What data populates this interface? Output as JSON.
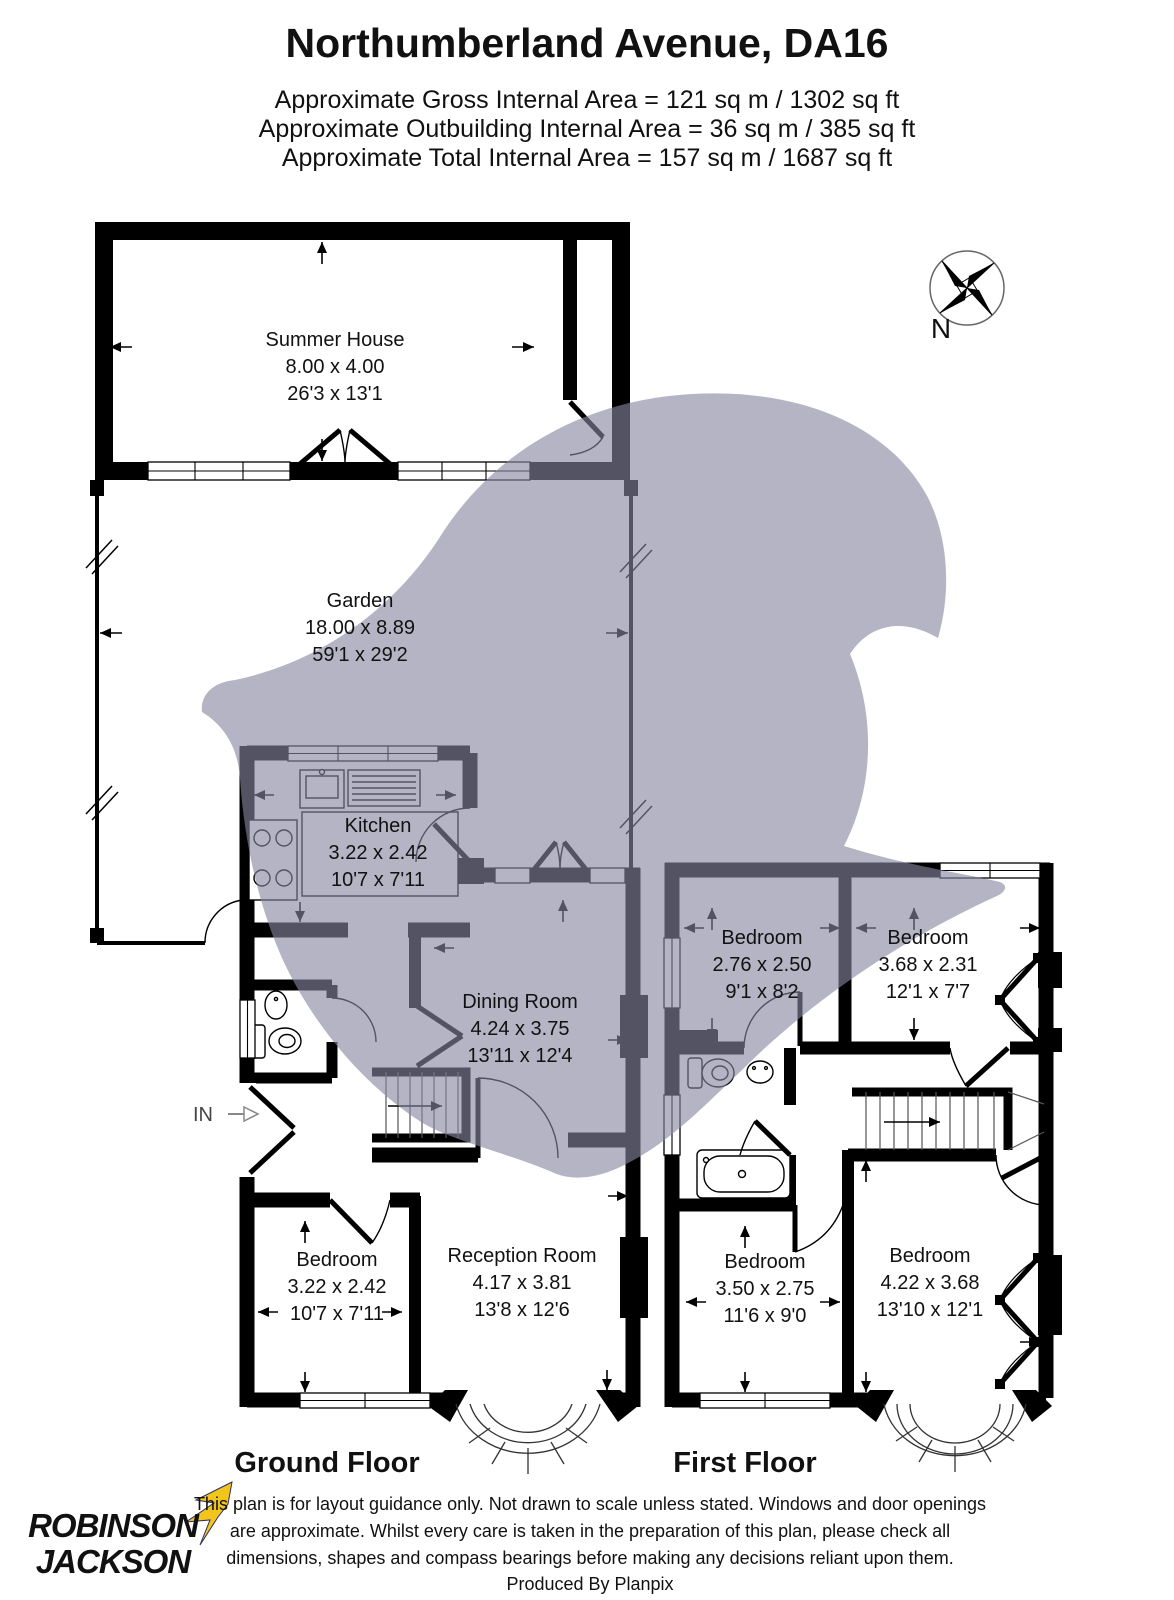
{
  "header": {
    "title": "Northumberland Avenue, DA16",
    "area_lines": [
      "Approximate Gross Internal Area = 121 sq m / 1302 sq ft",
      "Approximate Outbuilding Internal Area = 36 sq m / 385 sq ft",
      "Approximate Total Internal Area = 157 sq m / 1687 sq ft"
    ]
  },
  "compass": {
    "north_label": "N"
  },
  "entrance": {
    "in_label": "IN"
  },
  "rooms": [
    {
      "name": "Summer House",
      "dim_m": "8.00 x 4.00",
      "dim_ft": "26'3 x 13'1"
    },
    {
      "name": "Garden",
      "dim_m": "18.00 x 8.89",
      "dim_ft": "59'1 x 29'2"
    },
    {
      "name": "Kitchen",
      "dim_m": "3.22 x 2.42",
      "dim_ft": "10'7 x 7'11"
    },
    {
      "name": "Dining Room",
      "dim_m": "4.24 x 3.75",
      "dim_ft": "13'11 x 12'4"
    },
    {
      "name": "Bedroom",
      "dim_m": "3.22 x 2.42",
      "dim_ft": "10'7 x 7'11"
    },
    {
      "name": "Reception Room",
      "dim_m": "4.17 x 3.81",
      "dim_ft": "13'8 x 12'6"
    },
    {
      "name": "Bedroom",
      "dim_m": "2.76 x 2.50",
      "dim_ft": "9'1 x 8'2"
    },
    {
      "name": "Bedroom",
      "dim_m": "3.68 x 2.31",
      "dim_ft": "12'1 x 7'7"
    },
    {
      "name": "Bedroom",
      "dim_m": "3.50 x 2.75",
      "dim_ft": "11'6 x 9'0"
    },
    {
      "name": "Bedroom",
      "dim_m": "4.22 x 3.68",
      "dim_ft": "13'10 x 12'1"
    }
  ],
  "floors": {
    "ground": "Ground Floor",
    "first": "First Floor"
  },
  "logo": {
    "line1": "ROBINSON",
    "line2": "JACKSON"
  },
  "footer": {
    "lines": [
      "This plan is for layout guidance only. Not drawn to scale unless stated. Windows and door openings",
      "are approximate. Whilst every care is taken in the preparation of this plan, please check all",
      "dimensions, shapes and compass bearings before making any decisions reliant upon them.",
      "Produced By Planpix"
    ]
  },
  "colors": {
    "wall": "#000000",
    "watermark": "#8686a0",
    "logo_navy": "#2b2d66",
    "logo_yellow": "#f2c51d"
  }
}
